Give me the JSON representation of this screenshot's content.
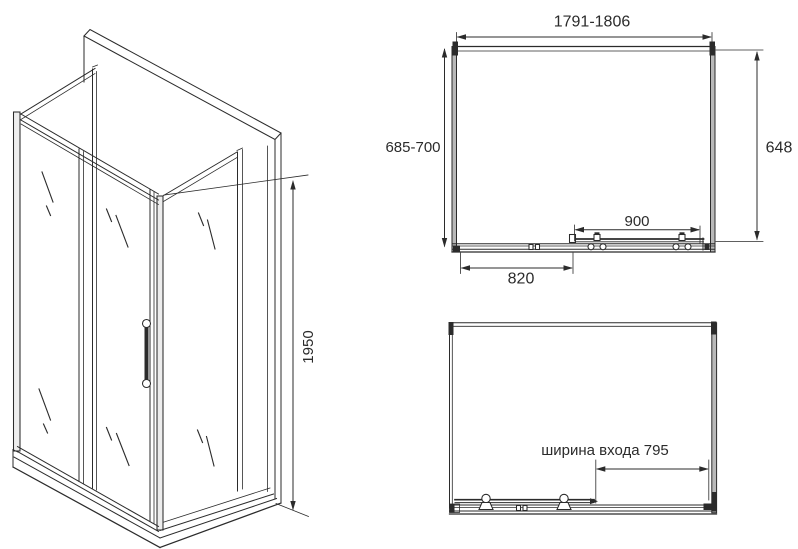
{
  "colors": {
    "line": "#2b2b2b",
    "wall_profile_fill": "#b8b8b8",
    "background": "#ffffff"
  },
  "isometric_view": {
    "height_label": "1950"
  },
  "plan_view_top": {
    "width_label": "1791-1806",
    "depth_label": "685-700",
    "side_label": "648",
    "door_label": "900",
    "fixed_panel_label": "820"
  },
  "plan_view_bottom": {
    "entrance_label": "ширина входа 795"
  }
}
